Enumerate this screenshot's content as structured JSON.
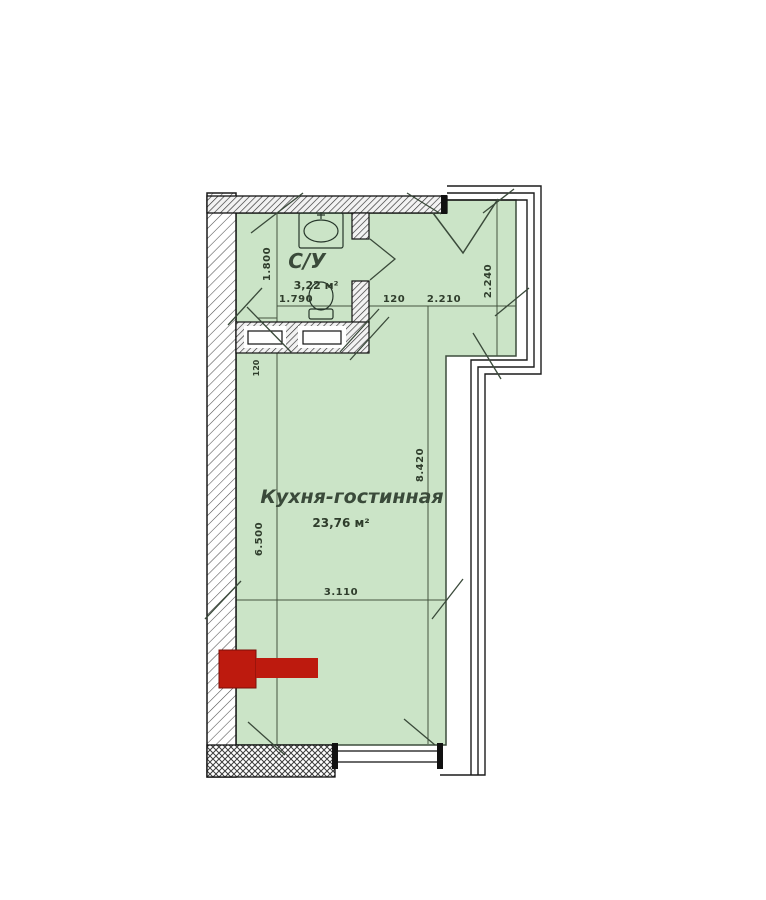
{
  "meta": {
    "type": "apartment floor plan"
  },
  "rooms": {
    "bathroom": {
      "name": "С/У",
      "area": "3,22 м²"
    },
    "main": {
      "name": "Кухня-гостинная",
      "area": "23,76 м²"
    }
  },
  "dimensions": {
    "bath_height": "1.800",
    "bath_width": "1.790",
    "entry_offset": "120",
    "entry_width": "2.210",
    "entry_height": "2.240",
    "room_height": "8.420",
    "room_left_height": "6.500",
    "room_width": "3.110",
    "wall_thickness": "120"
  },
  "colors": {
    "floor_fill": "#cbe4c7",
    "marker_red": "#bd1a0e",
    "line_dark": "#3a4a3a"
  }
}
